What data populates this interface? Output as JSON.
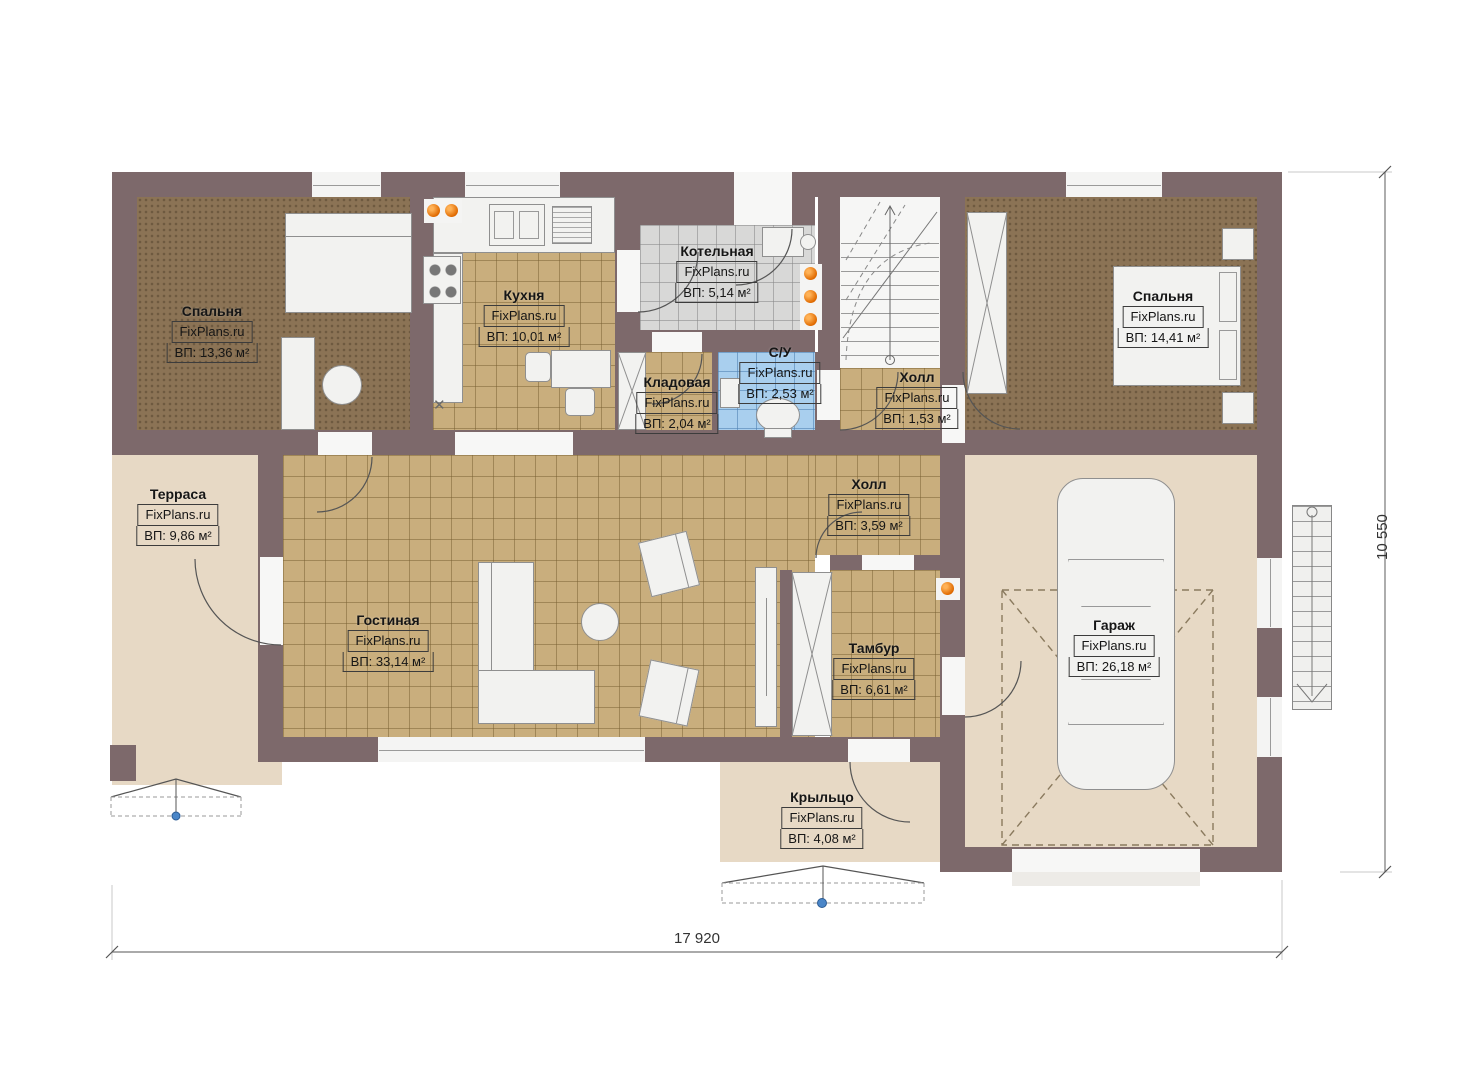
{
  "brand": "FixPlans.ru",
  "rooms": {
    "bedroom_left": {
      "name": "Спальня",
      "area": "ВП: 13,36 м²"
    },
    "kitchen": {
      "name": "Кухня",
      "area": "ВП: 10,01 м²"
    },
    "boiler": {
      "name": "Котельная",
      "area": "ВП: 5,14 м²"
    },
    "pantry": {
      "name": "Кладовая",
      "area": "ВП: 2,04 м²"
    },
    "bathroom": {
      "name": "С/У",
      "area": "ВП: 2,53 м²"
    },
    "hall_stairs": {
      "name": "Холл",
      "area": "ВП: 1,53 м²"
    },
    "bedroom_right": {
      "name": "Спальня",
      "area": "ВП: 14,41 м²"
    },
    "terrace": {
      "name": "Терраса",
      "area": "ВП: 9,86 м²"
    },
    "living": {
      "name": "Гостиная",
      "area": "ВП: 33,14 м²"
    },
    "hall": {
      "name": "Холл",
      "area": "ВП: 3,59 м²"
    },
    "vestibule": {
      "name": "Тамбур",
      "area": "ВП: 6,61 м²"
    },
    "garage": {
      "name": "Гараж",
      "area": "ВП: 26,18 м²"
    },
    "porch": {
      "name": "Крыльцо",
      "area": "ВП: 4,08 м²"
    }
  },
  "dimensions": {
    "width": "17 920",
    "height": "10 550"
  },
  "symbols": {
    "cross": "✕"
  },
  "colors": {
    "wall": "#7d696b",
    "tile_tan": "#c9ae7d",
    "carpet": "#8b7355",
    "tile_gray": "#d8d8d7",
    "tile_blue": "#a9cfee",
    "deck": "#e7d9c5",
    "radiator": "#e06a00",
    "marker_blue": "#4a86c8"
  }
}
